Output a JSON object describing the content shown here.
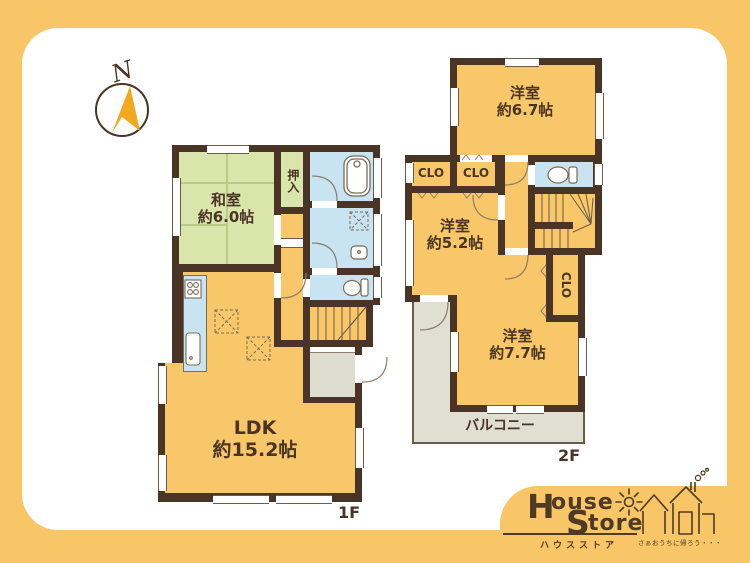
{
  "palette": {
    "bg_orange": "#F8C666",
    "wall_brown": "#4A3426",
    "room_orange": "#F7C76A",
    "tatami_green": "#D9E5AA",
    "water_blue": "#C8E3F1",
    "genkan_gray": "#DEDDD0",
    "balcony_gray": "#E0DFD2",
    "logo_brown": "#4F3A28",
    "compass_gold": "#F3A81D"
  },
  "compass": {
    "label": "N"
  },
  "floor1": {
    "label": "1F",
    "washitsu_name": "和室",
    "washitsu_size": "約6.0帖",
    "oshiire": "押入",
    "ldk_name": "LDK",
    "ldk_size": "約15.2帖"
  },
  "floor2": {
    "label": "2F",
    "room67_name": "洋室",
    "room67_size": "約6.7帖",
    "room52_name": "洋室",
    "room52_size": "約5.2帖",
    "room77_name": "洋室",
    "room77_size": "約7.7帖",
    "closet_label": "CLO",
    "balcony": "バルコニー"
  },
  "logo": {
    "h": "H",
    "ouse": "ouse",
    "s": "S",
    "tore": "tore",
    "kana": "ハウスストア",
    "tagline": "さぁおうちに帰ろう・・・"
  }
}
